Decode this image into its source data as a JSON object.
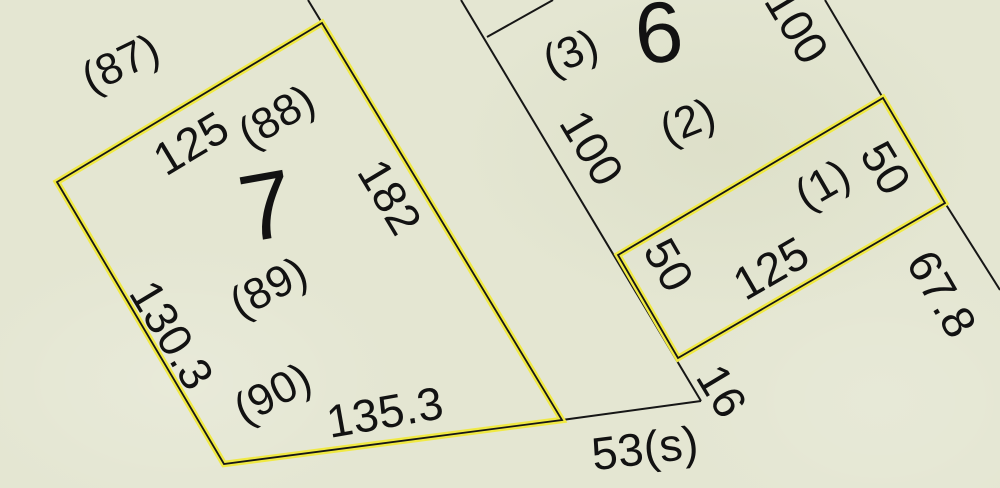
{
  "map": {
    "type": "cadastral-plat-map",
    "background_color": "#e4e6d2",
    "line_color": "#161616",
    "highlight_color": "#f0e944",
    "text_color": "#121212",
    "highlighted_parcels": [
      {
        "name": "parcel-7-outline",
        "lot_number": "7",
        "points": "322,23 57,182 224,464 562,420",
        "dimensions": [
          "125",
          "182",
          "135.3",
          "130.3"
        ]
      },
      {
        "name": "parcel-1-outline",
        "lot_number": "(1)",
        "points": "618,255 883,98 945,203 678,358",
        "dimensions": [
          "125",
          "50",
          "50"
        ]
      }
    ],
    "boundary_segments": [
      {
        "name": "lot6-west-boundary-line",
        "x1": 461,
        "y1": 0,
        "x2": 701,
        "y2": 401
      },
      {
        "name": "north-branch-line",
        "x1": 487,
        "y1": 37,
        "x2": 553,
        "y2": 0
      },
      {
        "name": "east-road-line",
        "x1": 825,
        "y1": 0,
        "x2": 945,
        "y2": 203
      },
      {
        "name": "southeast-edge-line",
        "x1": 945,
        "y1": 203,
        "x2": 1000,
        "y2": 290
      },
      {
        "name": "south-boundary-line-53s",
        "x1": 562,
        "y1": 420,
        "x2": 701,
        "y2": 401
      },
      {
        "name": "north-extension-line",
        "x1": 308,
        "y1": 0,
        "x2": 322,
        "y2": 23
      }
    ],
    "labels": [
      {
        "name": "ref-number-87",
        "text": "(87)",
        "x": 121,
        "y": 64,
        "rot": -26,
        "size": 44
      },
      {
        "name": "dim-125-lot7-north",
        "text": "125",
        "x": 191,
        "y": 143,
        "rot": -31,
        "size": 46
      },
      {
        "name": "ref-number-88",
        "text": "(88)",
        "x": 277,
        "y": 117,
        "rot": -31,
        "size": 44
      },
      {
        "name": "lot-number-7",
        "text": "7",
        "x": 267,
        "y": 207,
        "rot": -10,
        "size": 95
      },
      {
        "name": "dim-182-lot7-east",
        "text": "182",
        "x": 390,
        "y": 197,
        "rot": 59,
        "size": 46
      },
      {
        "name": "dim-130-3-lot7-west",
        "text": "130.3",
        "x": 172,
        "y": 335,
        "rot": 59,
        "size": 46
      },
      {
        "name": "ref-number-89",
        "text": "(89)",
        "x": 269,
        "y": 288,
        "rot": -28,
        "size": 44
      },
      {
        "name": "ref-number-90",
        "text": "(90)",
        "x": 273,
        "y": 394,
        "rot": -28,
        "size": 44
      },
      {
        "name": "dim-135-3-lot7-south",
        "text": "135.3",
        "x": 385,
        "y": 412,
        "rot": -10,
        "size": 46
      },
      {
        "name": "dim-53s-south-road",
        "text": "53(s)",
        "x": 645,
        "y": 448,
        "rot": -7,
        "size": 46
      },
      {
        "name": "dim-16-boundary",
        "text": "16",
        "x": 722,
        "y": 391,
        "rot": 59,
        "size": 46
      },
      {
        "name": "ref-number-3",
        "text": "(3)",
        "x": 571,
        "y": 53,
        "rot": -22,
        "size": 44
      },
      {
        "name": "lot-number-6",
        "text": "6",
        "x": 659,
        "y": 33,
        "rot": -6,
        "size": 86
      },
      {
        "name": "ref-number-2",
        "text": "(2)",
        "x": 688,
        "y": 122,
        "rot": -22,
        "size": 44
      },
      {
        "name": "dim-100-lot6-west",
        "text": "100",
        "x": 592,
        "y": 148,
        "rot": 59,
        "size": 46
      },
      {
        "name": "dim-100-lot6-east",
        "text": "100",
        "x": 797,
        "y": 26,
        "rot": 59,
        "size": 46
      },
      {
        "name": "ref-number-1",
        "text": "(1)",
        "x": 823,
        "y": 185,
        "rot": -30,
        "size": 44
      },
      {
        "name": "dim-50-parcel1-east",
        "text": "50",
        "x": 886,
        "y": 168,
        "rot": 59,
        "size": 46
      },
      {
        "name": "dim-50-parcel1-west",
        "text": "50",
        "x": 669,
        "y": 265,
        "rot": 60,
        "size": 46
      },
      {
        "name": "dim-125-parcel1",
        "text": "125",
        "x": 771,
        "y": 268,
        "rot": -30,
        "size": 46
      },
      {
        "name": "dim-67-8-southeast",
        "text": "67.8",
        "x": 942,
        "y": 294,
        "rot": 60,
        "size": 46
      }
    ]
  }
}
